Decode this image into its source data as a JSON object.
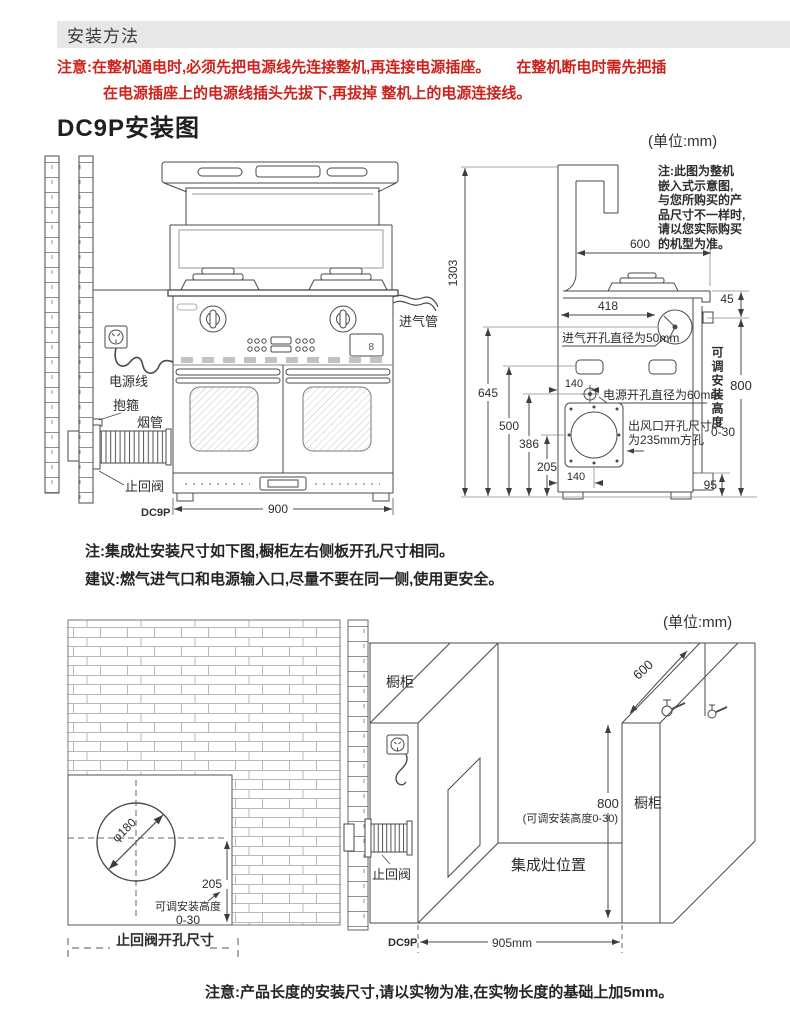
{
  "header": {
    "title": "安装方法"
  },
  "warning": {
    "line1": "注意:在整机通电时,必须先把电源线先连接整机,再连接电源插座。",
    "line1b": "在整机断电时需先把插",
    "line2": "在电源插座上的电源线插头先拔下,再拔掉 整机上的电源连接线。"
  },
  "section1": {
    "title": "DC9P安装图",
    "unit": "(单位:mm)"
  },
  "front_view": {
    "label_power_cord": "电源线",
    "label_clamp": "抱箍",
    "label_smoke_pipe": "烟管",
    "label_check_valve": "止回阀",
    "label_intake_pipe": "进气管",
    "model": "DC9P",
    "dim_width": "900",
    "display_value": "8"
  },
  "side_view": {
    "note_lines": [
      "注:此图为整机",
      "嵌入式示意图,",
      "与您所购买的产",
      "品尺寸不一样时,",
      "请以您实际购买",
      "的机型为准。"
    ],
    "dim_total_height": "1303",
    "dim_depth": "600",
    "dim_top_gap": "45",
    "dim_intake_x": "418",
    "label_intake_hole": "进气开孔直径为50mm",
    "dim_645": "645",
    "dim_500": "500",
    "dim_386": "386",
    "dim_205": "205",
    "dim_140_top": "140",
    "label_power_hole": "电源开孔直径为60mm",
    "label_outlet_line1": "出风口开孔尺寸",
    "label_outlet_line2": "为235mm方孔",
    "dim_140_bottom": "140",
    "label_adjustable": "可调安装高度",
    "dim_800": "800",
    "range_adjustable": "0-30",
    "dim_95": "95"
  },
  "mid_notes": {
    "note": "注:集成灶安装尺寸如下图,橱柜左右侧板开孔尺寸相同。",
    "suggestion": "建议:燃气进气口和电源输入口,尽量不要在同一侧,使用更安全。",
    "unit": "(单位:mm)"
  },
  "hole_view": {
    "dim_diameter": "φ180",
    "dim_205": "205",
    "label_adjustable": "可调安装高度",
    "range_adjustable": "0-30",
    "caption": "止回阀开孔尺寸"
  },
  "cabinet_view": {
    "label_cabinet_left": "橱柜",
    "label_cabinet_right": "橱柜",
    "dim_depth": "600",
    "dim_800": "800",
    "note_adjustable": "(可调安装高度0-30)",
    "label_stove_position": "集成灶位置",
    "label_check_valve": "止回阀",
    "model": "DC9P",
    "dim_width": "905mm"
  },
  "footer": {
    "note": "注意:产品长度的安装尺寸,请以实物为准,在实物长度的基础上加5mm。"
  },
  "colors": {
    "warning_red": "#cd231d",
    "header_bg": "#e7e7e7",
    "line": "#4a4a4a"
  }
}
